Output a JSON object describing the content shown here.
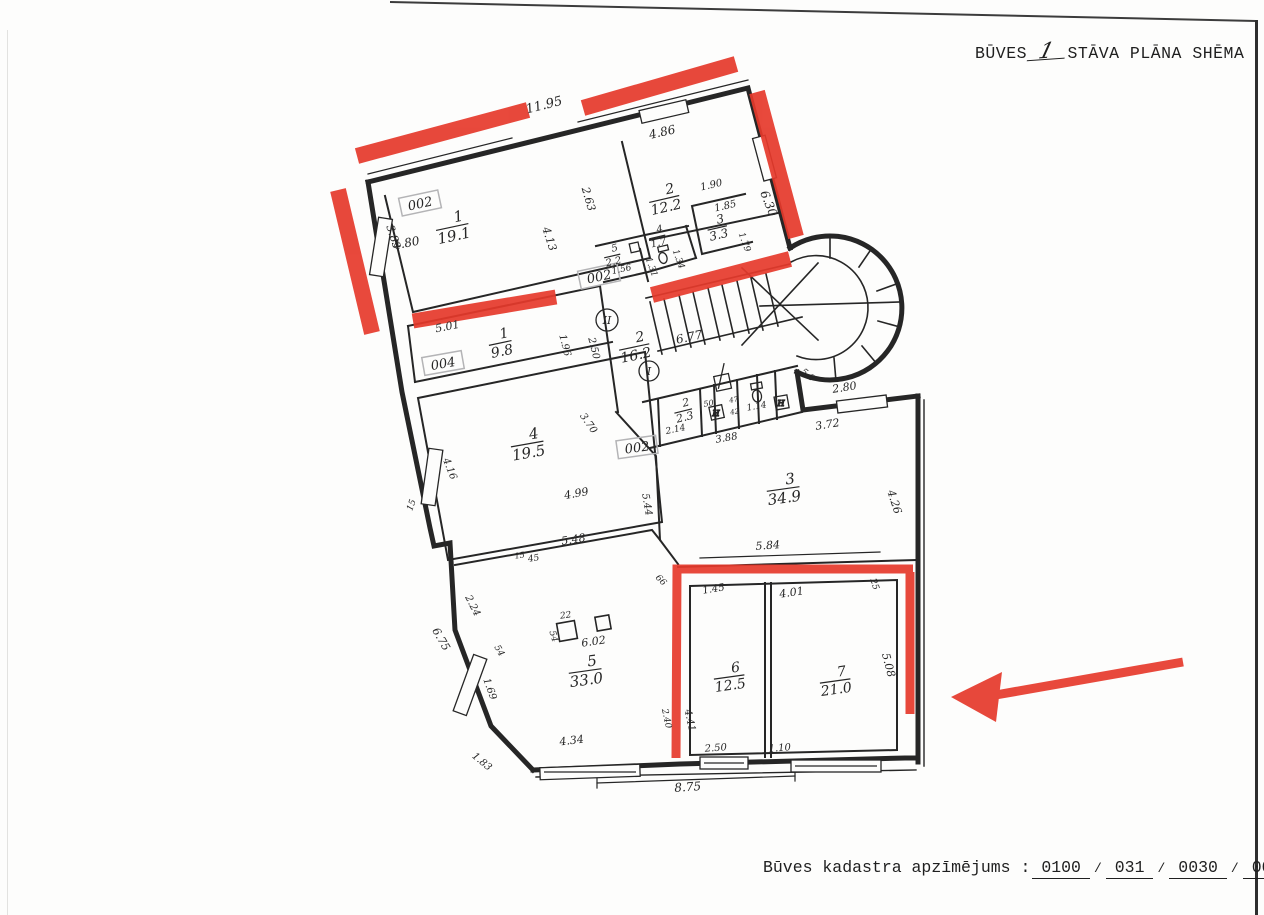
{
  "title": {
    "prefix": "BŪVES",
    "floor": "1",
    "suffix": "STĀVA PLĀNA SHĒMA"
  },
  "footer": {
    "label": "Būves kadastra apzīmējums :",
    "parts": [
      "0100",
      "031",
      "0030",
      "001"
    ],
    "sep": "/"
  },
  "colors": {
    "red": "#e6392b",
    "ink": "#262626",
    "stamp": "#b4b4b6"
  },
  "plan": {
    "rooms": [
      {
        "num": "1",
        "area": "19.1",
        "x": 452,
        "y": 226,
        "r": -12,
        "s": 15
      },
      {
        "num": "2",
        "area": "12.2",
        "x": 664,
        "y": 198,
        "r": -13,
        "s": 14
      },
      {
        "num": "3",
        "area": "3.3",
        "x": 717,
        "y": 227,
        "r": -13,
        "s": 12
      },
      {
        "num": "4",
        "area": "1.7",
        "x": 657,
        "y": 236,
        "r": -13,
        "s": 10
      },
      {
        "num": "5",
        "area": "2.2",
        "x": 612,
        "y": 255,
        "r": -13,
        "s": 10
      },
      {
        "num": "1",
        "area": "9.8",
        "x": 500,
        "y": 342,
        "r": -12,
        "s": 14
      },
      {
        "num": "2",
        "area": "16.2",
        "x": 634,
        "y": 346,
        "r": -12,
        "s": 14
      },
      {
        "num": "4",
        "area": "19.5",
        "x": 527,
        "y": 443,
        "r": -10,
        "s": 15
      },
      {
        "num": "2",
        "area": "2.3",
        "x": 683,
        "y": 410,
        "r": -14,
        "s": 11
      },
      {
        "num": "3",
        "area": "34.9",
        "x": 783,
        "y": 488,
        "r": -8,
        "s": 15
      },
      {
        "num": "5",
        "area": "33.0",
        "x": 585,
        "y": 670,
        "r": -8,
        "s": 15
      },
      {
        "num": "6",
        "area": "12.5",
        "x": 729,
        "y": 676,
        "r": -8,
        "s": 14
      },
      {
        "num": "7",
        "area": "21.0",
        "x": 835,
        "y": 680,
        "r": -8,
        "s": 14
      }
    ],
    "dims": [
      {
        "t": "11.95",
        "x": 545,
        "y": 109,
        "r": -14,
        "s": 13
      },
      {
        "t": "4.86",
        "x": 663,
        "y": 136,
        "r": -13,
        "s": 12
      },
      {
        "t": "2.63",
        "x": 585,
        "y": 200,
        "r": 74,
        "s": 11
      },
      {
        "t": "6.30",
        "x": 765,
        "y": 205,
        "r": 68,
        "s": 12
      },
      {
        "t": "1.90",
        "x": 712,
        "y": 188,
        "r": -13,
        "s": 10
      },
      {
        "t": "1.85",
        "x": 726,
        "y": 209,
        "r": -13,
        "s": 10
      },
      {
        "t": "1.79",
        "x": 742,
        "y": 243,
        "r": 70,
        "s": 9
      },
      {
        "t": "4.80",
        "x": 407,
        "y": 247,
        "r": -11,
        "s": 12
      },
      {
        "t": "3.83",
        "x": 390,
        "y": 238,
        "r": 72,
        "s": 11
      },
      {
        "t": "4.13",
        "x": 546,
        "y": 240,
        "r": 72,
        "s": 11
      },
      {
        "t": "1.56",
        "x": 622,
        "y": 272,
        "r": -12,
        "s": 9
      },
      {
        "t": "1.31",
        "x": 649,
        "y": 268,
        "r": 70,
        "s": 9
      },
      {
        "t": "1.34",
        "x": 676,
        "y": 260,
        "r": 70,
        "s": 9
      },
      {
        "t": "5.01",
        "x": 448,
        "y": 330,
        "r": -11,
        "s": 11
      },
      {
        "t": "1.96",
        "x": 562,
        "y": 346,
        "r": 76,
        "s": 10
      },
      {
        "t": "2.50",
        "x": 591,
        "y": 349,
        "r": 76,
        "s": 10
      },
      {
        "t": "6.77",
        "x": 690,
        "y": 341,
        "r": -12,
        "s": 12
      },
      {
        "t": "5.8",
        "x": 806,
        "y": 377,
        "r": 40,
        "s": 9
      },
      {
        "t": "2.80",
        "x": 845,
        "y": 391,
        "r": -9,
        "s": 11
      },
      {
        "t": "3.72",
        "x": 828,
        "y": 428,
        "r": -9,
        "s": 11
      },
      {
        "t": "4.26",
        "x": 891,
        "y": 503,
        "r": 72,
        "s": 11
      },
      {
        "t": "5.84",
        "x": 768,
        "y": 549,
        "r": -4,
        "s": 11
      },
      {
        "t": "2.14",
        "x": 676,
        "y": 432,
        "r": -12,
        "s": 9
      },
      {
        "t": "3.88",
        "x": 727,
        "y": 441,
        "r": -10,
        "s": 10
      },
      {
        "t": "1.14",
        "x": 757,
        "y": 409,
        "r": -10,
        "s": 9
      },
      {
        "t": "50",
        "x": 709,
        "y": 406,
        "r": -10,
        "s": 8
      },
      {
        "t": "47",
        "x": 734,
        "y": 402,
        "r": -10,
        "s": 7
      },
      {
        "t": "42",
        "x": 735,
        "y": 414,
        "r": -10,
        "s": 7
      },
      {
        "t": "4.99",
        "x": 577,
        "y": 497,
        "r": -10,
        "s": 11
      },
      {
        "t": "5.48",
        "x": 574,
        "y": 543,
        "r": -9,
        "s": 11
      },
      {
        "t": "3.70",
        "x": 586,
        "y": 425,
        "r": 55,
        "s": 10
      },
      {
        "t": "5.44",
        "x": 644,
        "y": 505,
        "r": 80,
        "s": 10
      },
      {
        "t": "4.16",
        "x": 447,
        "y": 470,
        "r": 68,
        "s": 10
      },
      {
        "t": "15",
        "x": 414,
        "y": 506,
        "r": -70,
        "s": 9
      },
      {
        "t": "15",
        "x": 520,
        "y": 558,
        "r": -9,
        "s": 8
      },
      {
        "t": "45",
        "x": 534,
        "y": 561,
        "r": -9,
        "s": 9
      },
      {
        "t": "2.24",
        "x": 470,
        "y": 607,
        "r": 63,
        "s": 10
      },
      {
        "t": "6.75",
        "x": 438,
        "y": 641,
        "r": 60,
        "s": 11
      },
      {
        "t": "54",
        "x": 497,
        "y": 652,
        "r": 60,
        "s": 9
      },
      {
        "t": "54",
        "x": 551,
        "y": 637,
        "r": 74,
        "s": 9
      },
      {
        "t": "22",
        "x": 566,
        "y": 618,
        "r": -8,
        "s": 9
      },
      {
        "t": "6.02",
        "x": 594,
        "y": 645,
        "r": -8,
        "s": 11
      },
      {
        "t": "1.69",
        "x": 487,
        "y": 690,
        "r": 70,
        "s": 10
      },
      {
        "t": "1.83",
        "x": 480,
        "y": 764,
        "r": 40,
        "s": 10
      },
      {
        "t": "4.34",
        "x": 572,
        "y": 744,
        "r": -7,
        "s": 11
      },
      {
        "t": "66",
        "x": 659,
        "y": 582,
        "r": 45,
        "s": 9
      },
      {
        "t": "2.40",
        "x": 664,
        "y": 719,
        "r": 78,
        "s": 9
      },
      {
        "t": "4.41",
        "x": 687,
        "y": 721,
        "r": 78,
        "s": 10
      },
      {
        "t": "1.45",
        "x": 714,
        "y": 592,
        "r": -9,
        "s": 10
      },
      {
        "t": "4.01",
        "x": 792,
        "y": 596,
        "r": -8,
        "s": 11
      },
      {
        "t": "25",
        "x": 872,
        "y": 585,
        "r": 72,
        "s": 9
      },
      {
        "t": "5.08",
        "x": 885,
        "y": 666,
        "r": 75,
        "s": 11
      },
      {
        "t": "2.50",
        "x": 716,
        "y": 751,
        "r": -4,
        "s": 10
      },
      {
        "t": "1.10",
        "x": 780,
        "y": 751,
        "r": -4,
        "s": 10
      },
      {
        "t": "8.75",
        "x": 688,
        "y": 791,
        "r": -4,
        "s": 12
      }
    ],
    "stamps": [
      {
        "t": "002",
        "x": 420,
        "y": 203,
        "r": -12
      },
      {
        "t": "002",
        "x": 599,
        "y": 276,
        "r": -12
      },
      {
        "t": "004",
        "x": 443,
        "y": 363,
        "r": -10
      },
      {
        "t": "002",
        "x": 637,
        "y": 447,
        "r": -8
      }
    ],
    "circles": [
      {
        "t": "II",
        "x": 607,
        "y": 320,
        "rad": 11
      },
      {
        "t": "I",
        "x": 649,
        "y": 371,
        "rad": 10
      }
    ]
  }
}
